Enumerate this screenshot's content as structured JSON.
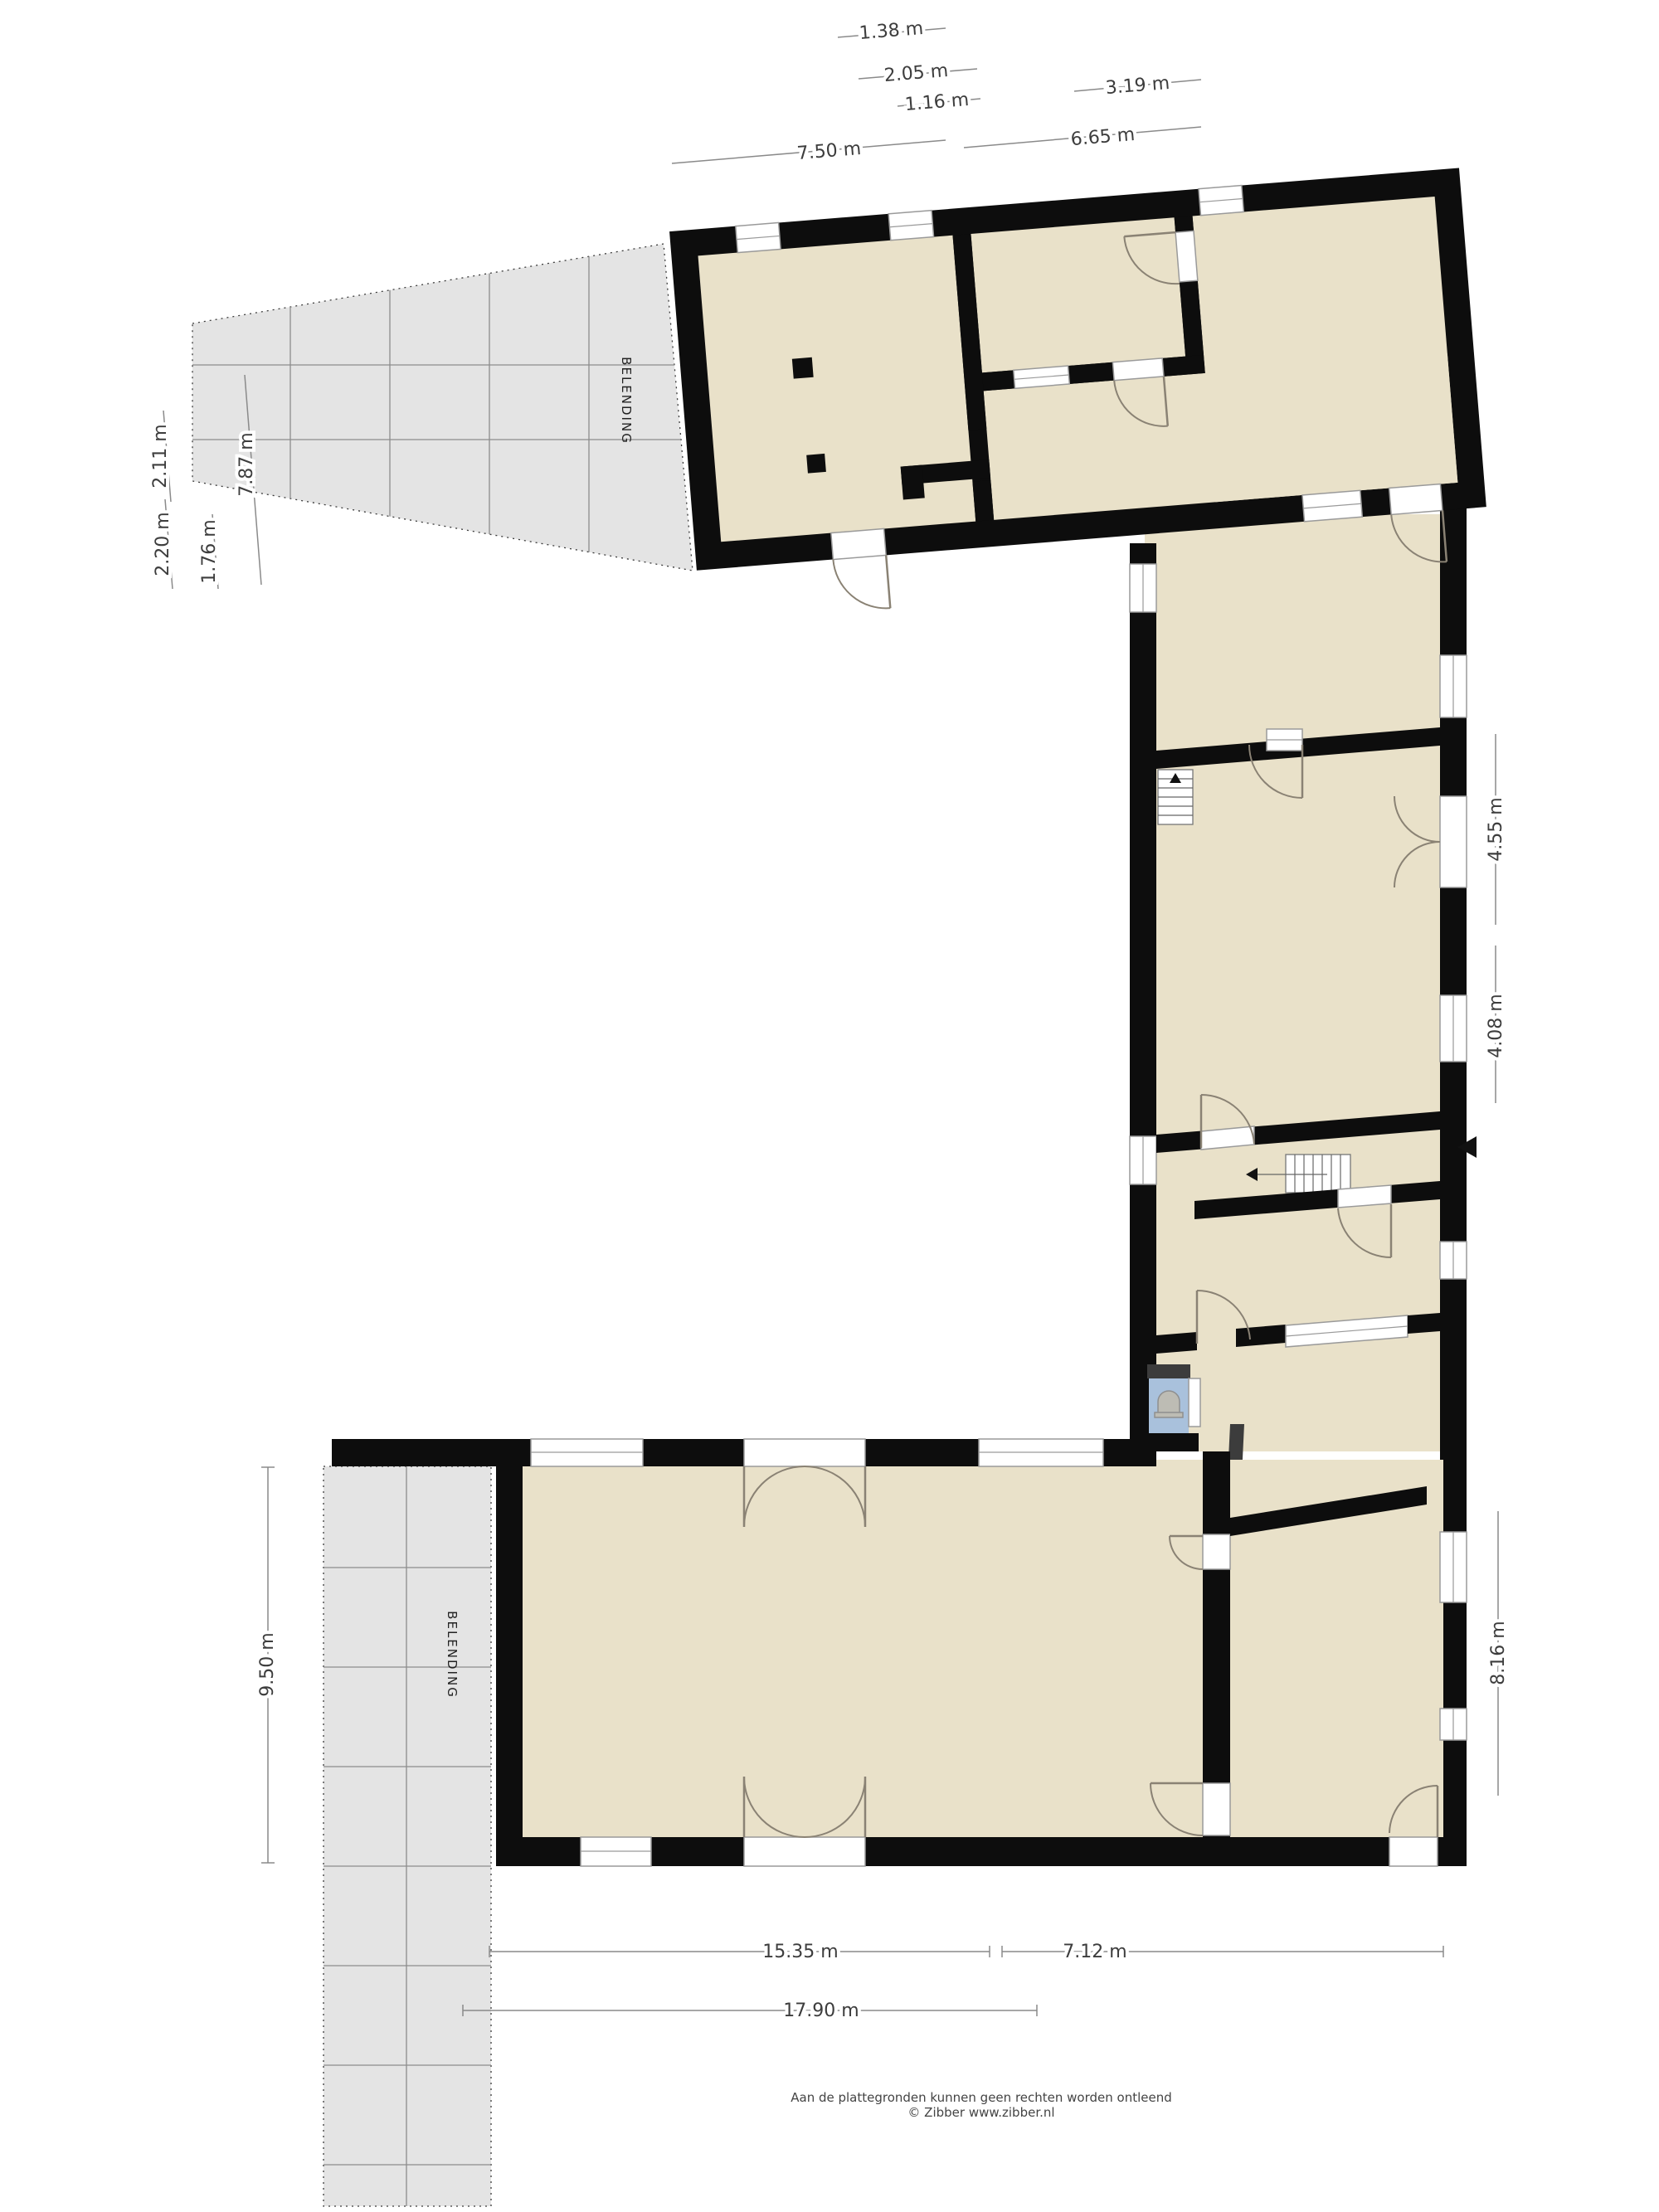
{
  "plan": {
    "belending_label": "BELENDING",
    "footer": {
      "line1": "Aan de plattegronden kunnen geen rechten worden ontleend",
      "line2": "© Zibber www.zibber.nl"
    },
    "dimensions": {
      "top": [
        "1.38 m",
        "2.05 m",
        "1.16 m",
        "3.19 m",
        "7.50 m",
        "6.65 m"
      ],
      "left_upper": [
        "2.11 m",
        "7.87 m",
        "2.20 m",
        "1.76 m"
      ],
      "left_lower": [
        "9.50 m"
      ],
      "right": [
        "4.55 m",
        "4.08 m",
        "8.16 m"
      ],
      "bottom": [
        "15.35 m",
        "7.12 m",
        "17.90 m"
      ]
    },
    "icons": {
      "entrance_marker": "left-triangle",
      "stairs_arrow": "direction-arrow",
      "toilet": "toilet-fixture"
    },
    "colors": {
      "room": "#e9e1c9",
      "wall": "#0d0d0d",
      "secondary_wall": "#3c3c3c",
      "adjacent_fill": "#e4e4e4",
      "adjacent_line": "#8c8c8c",
      "toilet_floor": "#a9c1dc",
      "fixture": "#bdbcb4",
      "dim_line": "#8a8a8a",
      "dim_text": "#3d3d3d",
      "door_arc": "#8a8274"
    }
  }
}
